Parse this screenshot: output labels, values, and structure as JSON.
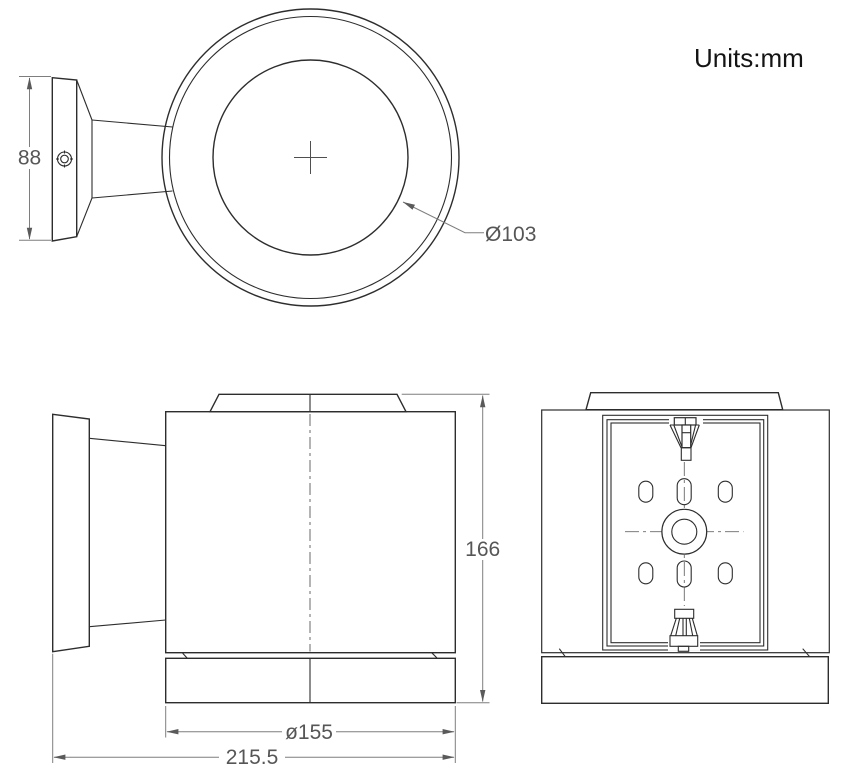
{
  "units_label": "Units:mm",
  "dimensions": {
    "canopy_height": "88",
    "lens_diameter": "Ø103",
    "body_height": "166",
    "body_diameter": "ø155",
    "overall_depth": "215.5"
  }
}
